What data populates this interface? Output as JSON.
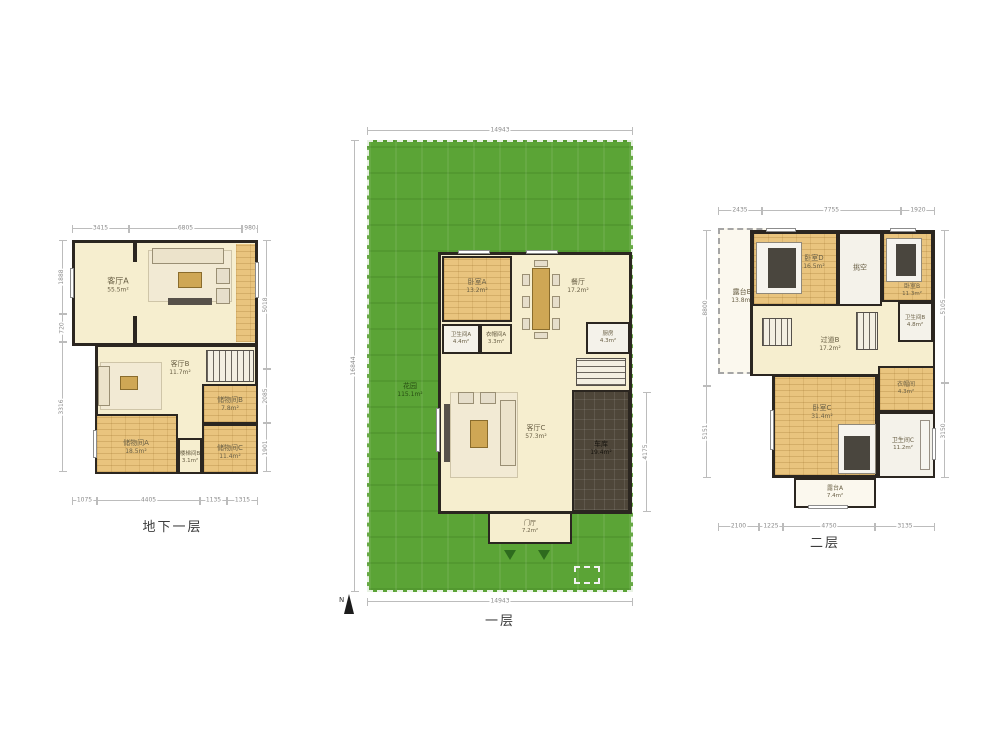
{
  "colors": {
    "garden_green": "#5ba436",
    "wood_floor": "#e9c47e",
    "room_cream": "#f6eecf",
    "wall": "#2b2620",
    "garage_dark": "#4e4639"
  },
  "plans": {
    "basement": {
      "title": "地下一层",
      "rooms": {
        "living_a": {
          "name": "客厅A",
          "area": "55.5m²"
        },
        "living_b": {
          "name": "客厅B",
          "area": "11.7m²"
        },
        "storage_b": {
          "name": "储物间B",
          "area": "7.8m²"
        },
        "storage_a": {
          "name": "储物间A",
          "area": "18.5m²"
        },
        "stair_b": {
          "name": "楼梯间B",
          "area": "3.1m²"
        },
        "storage_c": {
          "name": "储物间C",
          "area": "11.4m²"
        }
      },
      "dims": {
        "top": [
          "3415",
          "6805",
          "980"
        ],
        "right": [
          "5018",
          "2085",
          "1901"
        ],
        "bottom": [
          "1075",
          "4405",
          "1135",
          "1315"
        ],
        "left": [
          "1888",
          "720",
          "3316"
        ]
      }
    },
    "first": {
      "title": "一层",
      "compass": "N",
      "rooms": {
        "garden": {
          "name": "花园",
          "area": "115.1m²"
        },
        "bedroom_a": {
          "name": "卧室A",
          "area": "13.2m²"
        },
        "dining": {
          "name": "餐厅",
          "area": "17.2m²"
        },
        "bath_a": {
          "name": "卫生间A",
          "area": "4.4m²"
        },
        "cloak_a": {
          "name": "衣帽间A",
          "area": "3.3m²"
        },
        "kitchen": {
          "name": "厨房",
          "area": "4.3m²"
        },
        "living_c": {
          "name": "客厅C",
          "area": "57.3m²"
        },
        "garage": {
          "name": "车库",
          "area": "19.4m²"
        },
        "foyer": {
          "name": "门厅",
          "area": "7.2m²"
        }
      },
      "dims": {
        "top": [
          "14943"
        ],
        "bottom": [
          "14943"
        ],
        "left": [
          "16844"
        ],
        "right": [
          "4175"
        ]
      }
    },
    "second": {
      "title": "二层",
      "rooms": {
        "terrace_b": {
          "name": "露台B",
          "area": "13.8m²"
        },
        "bedroom_d": {
          "name": "卧室D",
          "area": "16.5m²"
        },
        "void": {
          "name": "挑空",
          "area": ""
        },
        "bedroom_b": {
          "name": "卧室B",
          "area": "11.3m²"
        },
        "bath_b": {
          "name": "卫生间B",
          "area": "4.8m²"
        },
        "hallway": {
          "name": "过道B",
          "area": "17.2m²"
        },
        "bedroom_c": {
          "name": "卧室C",
          "area": "31.4m²"
        },
        "cloak": {
          "name": "衣帽间",
          "area": "4.3m²"
        },
        "bath_c": {
          "name": "卫生间C",
          "area": "11.2m²"
        },
        "terrace_a": {
          "name": "露台A",
          "area": "7.4m²"
        }
      },
      "dims": {
        "top": [
          "2435",
          "7755",
          "1920"
        ],
        "bottom": [
          "2100",
          "1225",
          "4750",
          "3135"
        ],
        "left": [
          "8800",
          "5151"
        ],
        "right": [
          "5105",
          "3150"
        ]
      }
    }
  }
}
